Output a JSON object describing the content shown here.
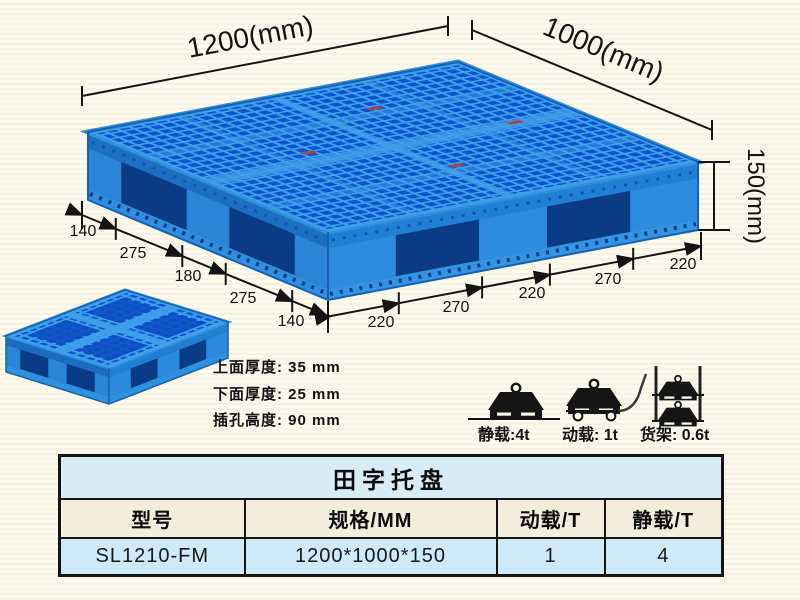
{
  "diagram": {
    "top_width_label": "1200(mm)",
    "top_depth_label": "1000(mm)",
    "height_label": "150(mm)",
    "left_edge_dims": [
      "140",
      "275",
      "180",
      "275",
      "140"
    ],
    "right_edge_dims": [
      "220",
      "270",
      "220",
      "270",
      "220"
    ],
    "spec_lines": [
      "上面厚度: 35 mm",
      "下面厚度: 25 mm",
      "插孔高度: 90 mm"
    ],
    "loads": [
      {
        "label": "静载:4t"
      },
      {
        "label": "动载: 1t"
      },
      {
        "label": "货架: 0.6t"
      }
    ]
  },
  "table": {
    "title": "田字托盘",
    "headers": [
      "型号",
      "规格/MM",
      "动载/T",
      "静载/T"
    ],
    "rows": [
      [
        "SL1210-FM",
        "1200*1000*150",
        "1",
        "4"
      ]
    ]
  },
  "colors": {
    "pallet_rib": "#3f9fe8",
    "pallet_hole": "#0d55cc",
    "pallet_face": "#1e74c8",
    "pallet_opening": "#0a3c86",
    "table_title_bg": "#d9ecf6",
    "table_header_bg": "#f2eddd",
    "table_data_bg": "#cfe9f7",
    "ink": "#141414"
  }
}
